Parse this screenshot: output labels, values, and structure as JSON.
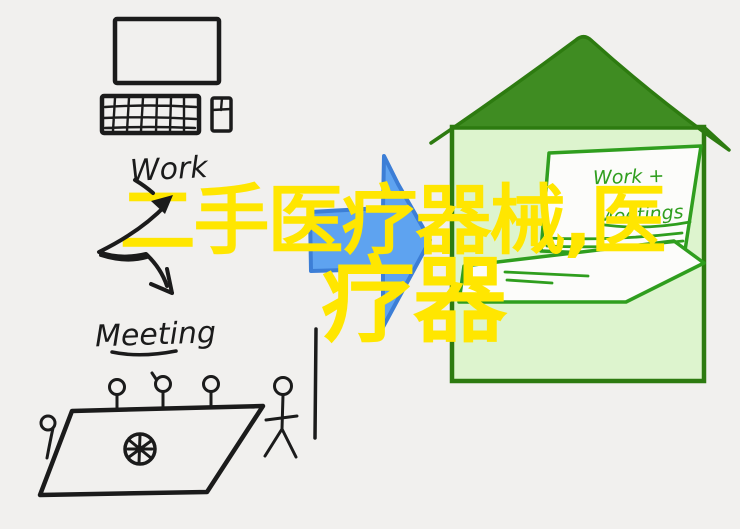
{
  "page": {
    "background_color": "#f1f0ee",
    "ink_color": "#1b1b1b"
  },
  "caption": {
    "line1": "二手医疗器械,医",
    "line2": "疗器",
    "color": "#ffe600"
  },
  "desktop_scene": {
    "label": "Work"
  },
  "meeting_scene": {
    "label": "Meeting"
  },
  "transition_arrow": {
    "fill": "#5ea3f0",
    "outline": "#3c7ed6"
  },
  "house_scene": {
    "roof_fill": "#3f8c22",
    "wall_fill": "#ddf4ce",
    "outline_color": "#2d7b10",
    "laptop_stroke": "#2f9e1e",
    "screen_line1": "Work +",
    "screen_line2": "Meetings"
  }
}
